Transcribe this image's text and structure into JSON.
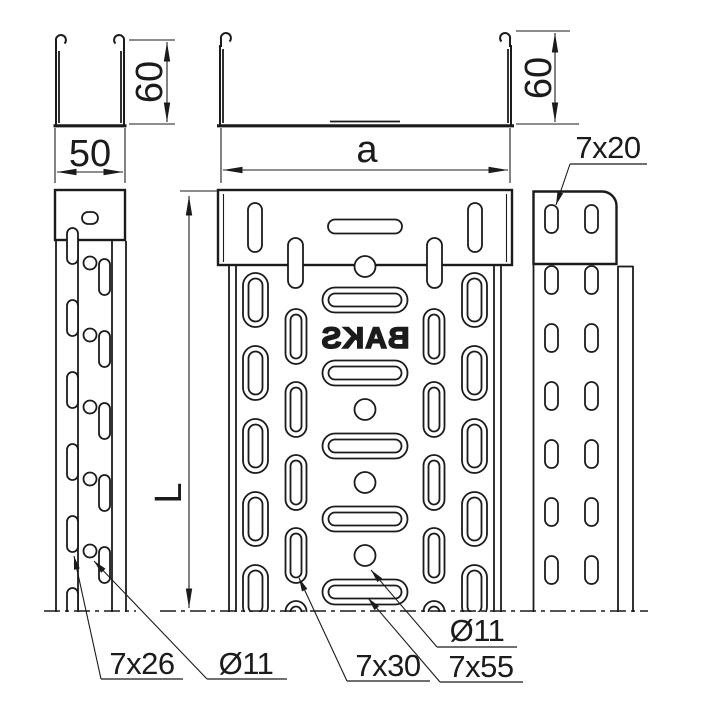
{
  "drawing": {
    "type": "cable-tray-technical-drawing",
    "brand_mark": "BAKS",
    "colors": {
      "line": "#1b1b1b",
      "background": "#ffffff"
    },
    "dimensions": {
      "small_section_width": "50",
      "small_section_height": "60",
      "large_section_width": "a",
      "large_section_height": "60",
      "tray_length": "L"
    },
    "labels": {
      "side_wall_slot": "7x20",
      "left_view_slot": "7x26",
      "left_view_hole": "Ø11",
      "bottom_slot_vertical": "7x30",
      "bottom_slot_horizontal": "7x55",
      "bottom_hole": "Ø11"
    }
  }
}
